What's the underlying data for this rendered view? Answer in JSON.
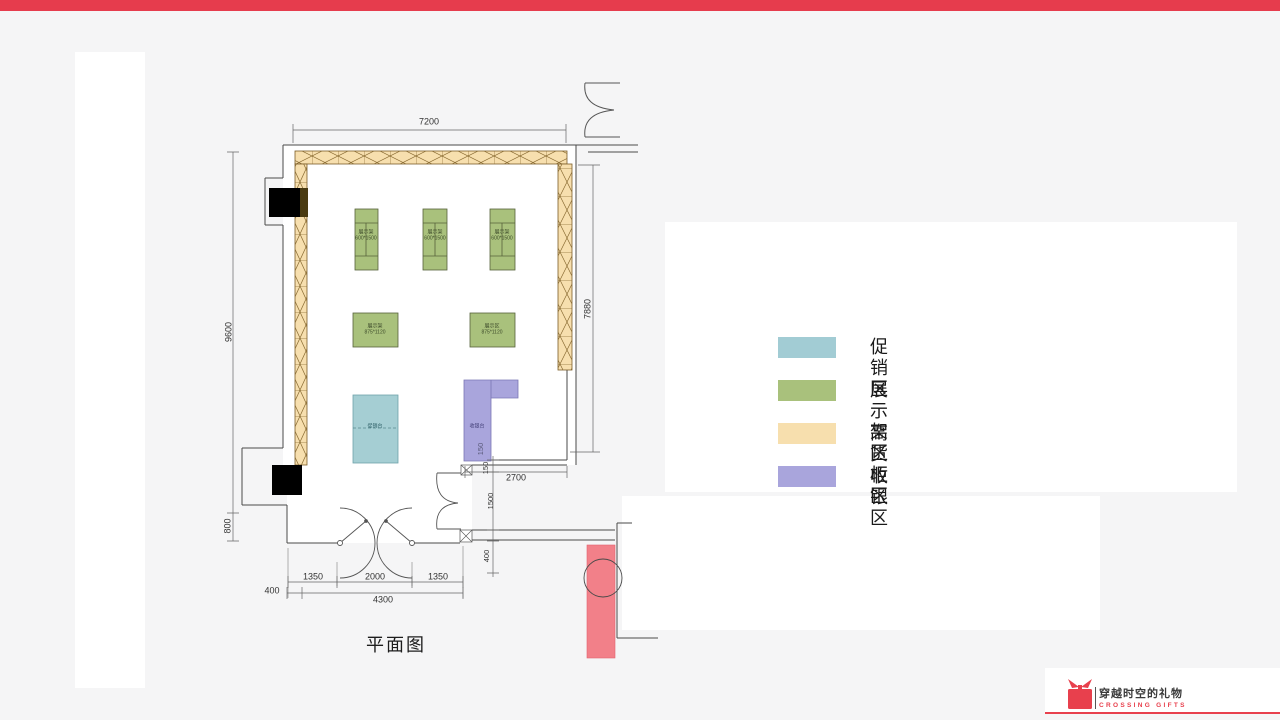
{
  "page": {
    "top_bar_color": "#e63c4d",
    "background_color": "#f5f5f6"
  },
  "plan": {
    "title": "平面图",
    "dimensions": {
      "top_width": "7200",
      "left_height": "9600",
      "left_bottom": "800",
      "right_height": "7880",
      "counter_depth": "150",
      "gap_150": "150",
      "opening_2700": "2700",
      "passage_1500": "1500",
      "right_400": "400",
      "door_left_1350": "1350",
      "door_2000": "2000",
      "door_right_1350": "1350",
      "bottom_400": "400",
      "bottom_total_4300": "4300"
    },
    "fixtures": {
      "rack_vertical_label": "展示架",
      "rack_vertical_size": "600*1500",
      "rack_square_label": "展示架",
      "rack_square2_label": "展示区",
      "rack_square_size": "875*1120",
      "promo_table_label": "促销台",
      "cashier_label": "收银台"
    },
    "zone_colors": {
      "promo": "#a5ced3",
      "display_rack": "#a9c17c",
      "high_cabinet": "#f7dfae",
      "cashier": "#a9a5dc",
      "highlight_red": "#f28089"
    }
  },
  "legend": {
    "items": [
      {
        "label": "促销区",
        "color": "#a2ccd4"
      },
      {
        "label": "展示架区",
        "color": "#a9c17c"
      },
      {
        "label": "高货柜区",
        "color": "#f7dfae"
      },
      {
        "label": "收银区",
        "color": "#a9a5dc"
      }
    ]
  },
  "logo": {
    "name": "穿越时空的礼物",
    "subtitle": "CROSSING GIFTS",
    "color": "#e8404d"
  }
}
